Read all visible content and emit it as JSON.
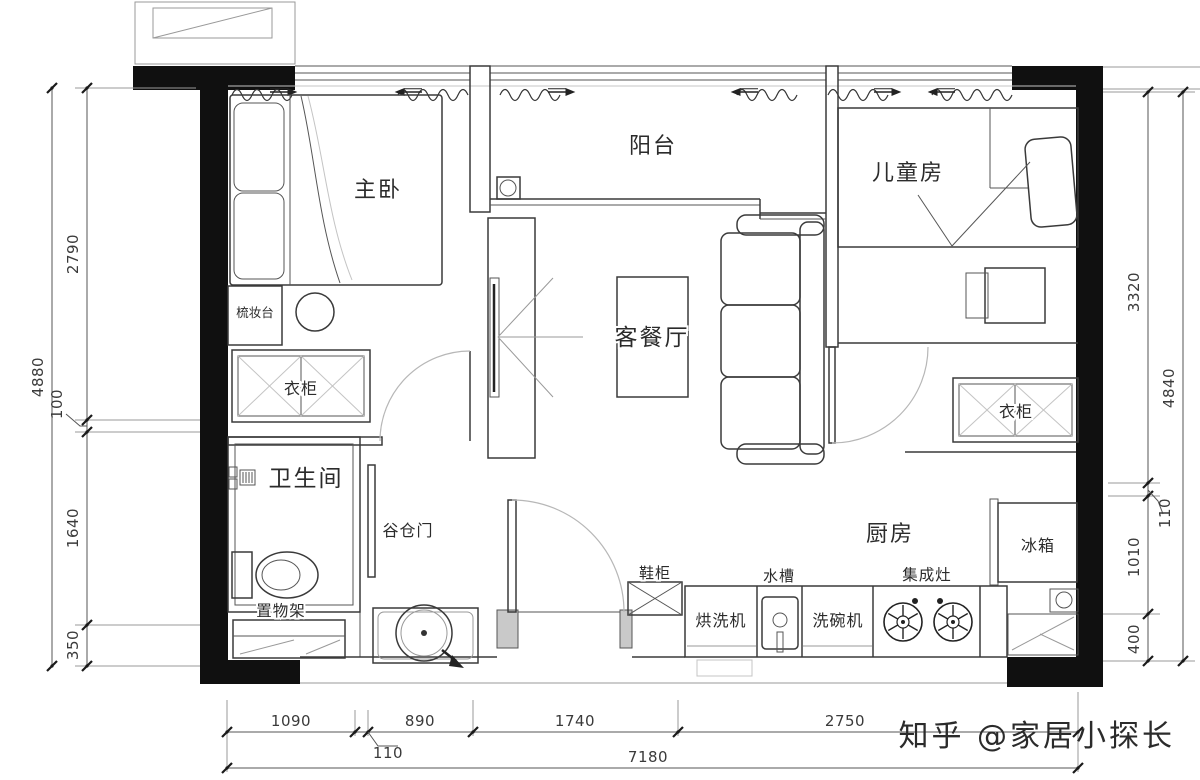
{
  "watermark": "知乎 @家居小探长",
  "rooms": {
    "master_bedroom": "主卧",
    "balcony": "阳台",
    "kids_room": "儿童房",
    "living_dining": "客餐厅",
    "bathroom": "卫生间",
    "kitchen": "厨房"
  },
  "labels": {
    "dressing_table": "梳妆台",
    "wardrobe_left": "衣柜",
    "wardrobe_right": "衣柜",
    "barn_door": "谷仓门",
    "shelf_rack": "置物架",
    "shoe_cabinet": "鞋柜",
    "washer_dryer": "烘洗机",
    "sink": "水槽",
    "dishwasher": "洗碗机",
    "integrated_stove": "集成灶",
    "fridge": "冰箱"
  },
  "dimensions": {
    "left_total": "4880",
    "left_segments": [
      "2790",
      "100",
      "1640",
      "350"
    ],
    "right_total": "4840",
    "right_segments": [
      "3320",
      "110",
      "1010",
      "400"
    ],
    "bottom_total": "7180",
    "bottom_segments": [
      "1090",
      "110",
      "890",
      "1740",
      "2750"
    ]
  },
  "colors": {
    "wall": "#101010",
    "line": "#3a3a3a",
    "watermark": "#ababab"
  }
}
